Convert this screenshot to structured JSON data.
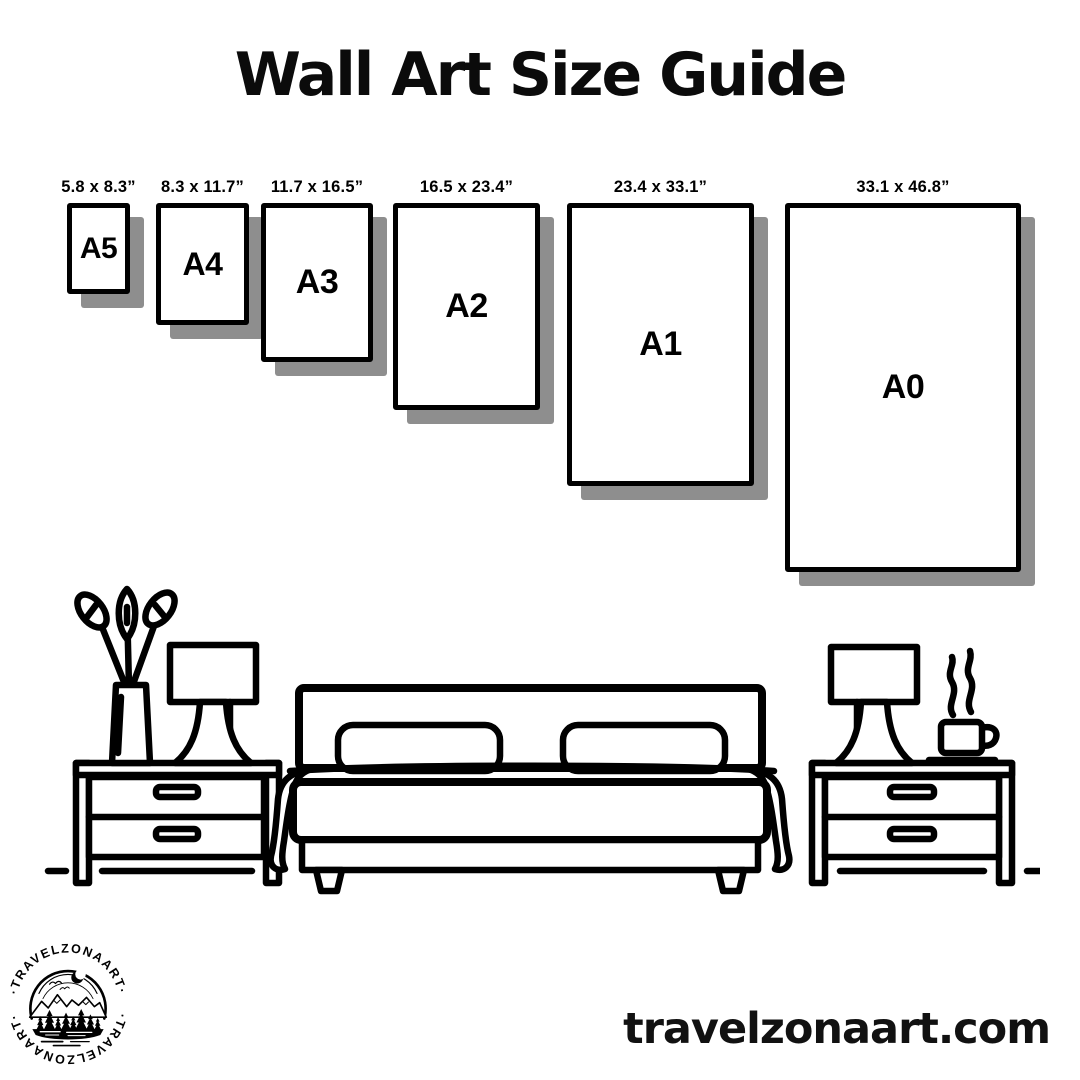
{
  "header": {
    "title": "Wall Art Size Guide"
  },
  "sizes": [
    {
      "label": "A5",
      "dims": "5.8 x 8.3”"
    },
    {
      "label": "A4",
      "dims": "8.3 x 11.7”"
    },
    {
      "label": "A3",
      "dims": "11.7 x 16.5”"
    },
    {
      "label": "A2",
      "dims": "16.5 x 23.4”"
    },
    {
      "label": "A1",
      "dims": "23.4 x 33.1”"
    },
    {
      "label": "A0",
      "dims": "33.1 x 46.8”"
    }
  ],
  "scene": {
    "items": [
      "plant",
      "table-lamp",
      "nightstand",
      "double-bed",
      "coffee-cup",
      "floor-line"
    ]
  },
  "logo": {
    "arc_text_top": "·TRAVELZONAART·",
    "arc_text_bottom": "·TRAVELZONAART·"
  },
  "footer": {
    "website": "travelzonaart.com"
  },
  "colors": {
    "ink": "#000000",
    "background": "#ffffff",
    "shadow": "#8e8e8e"
  }
}
